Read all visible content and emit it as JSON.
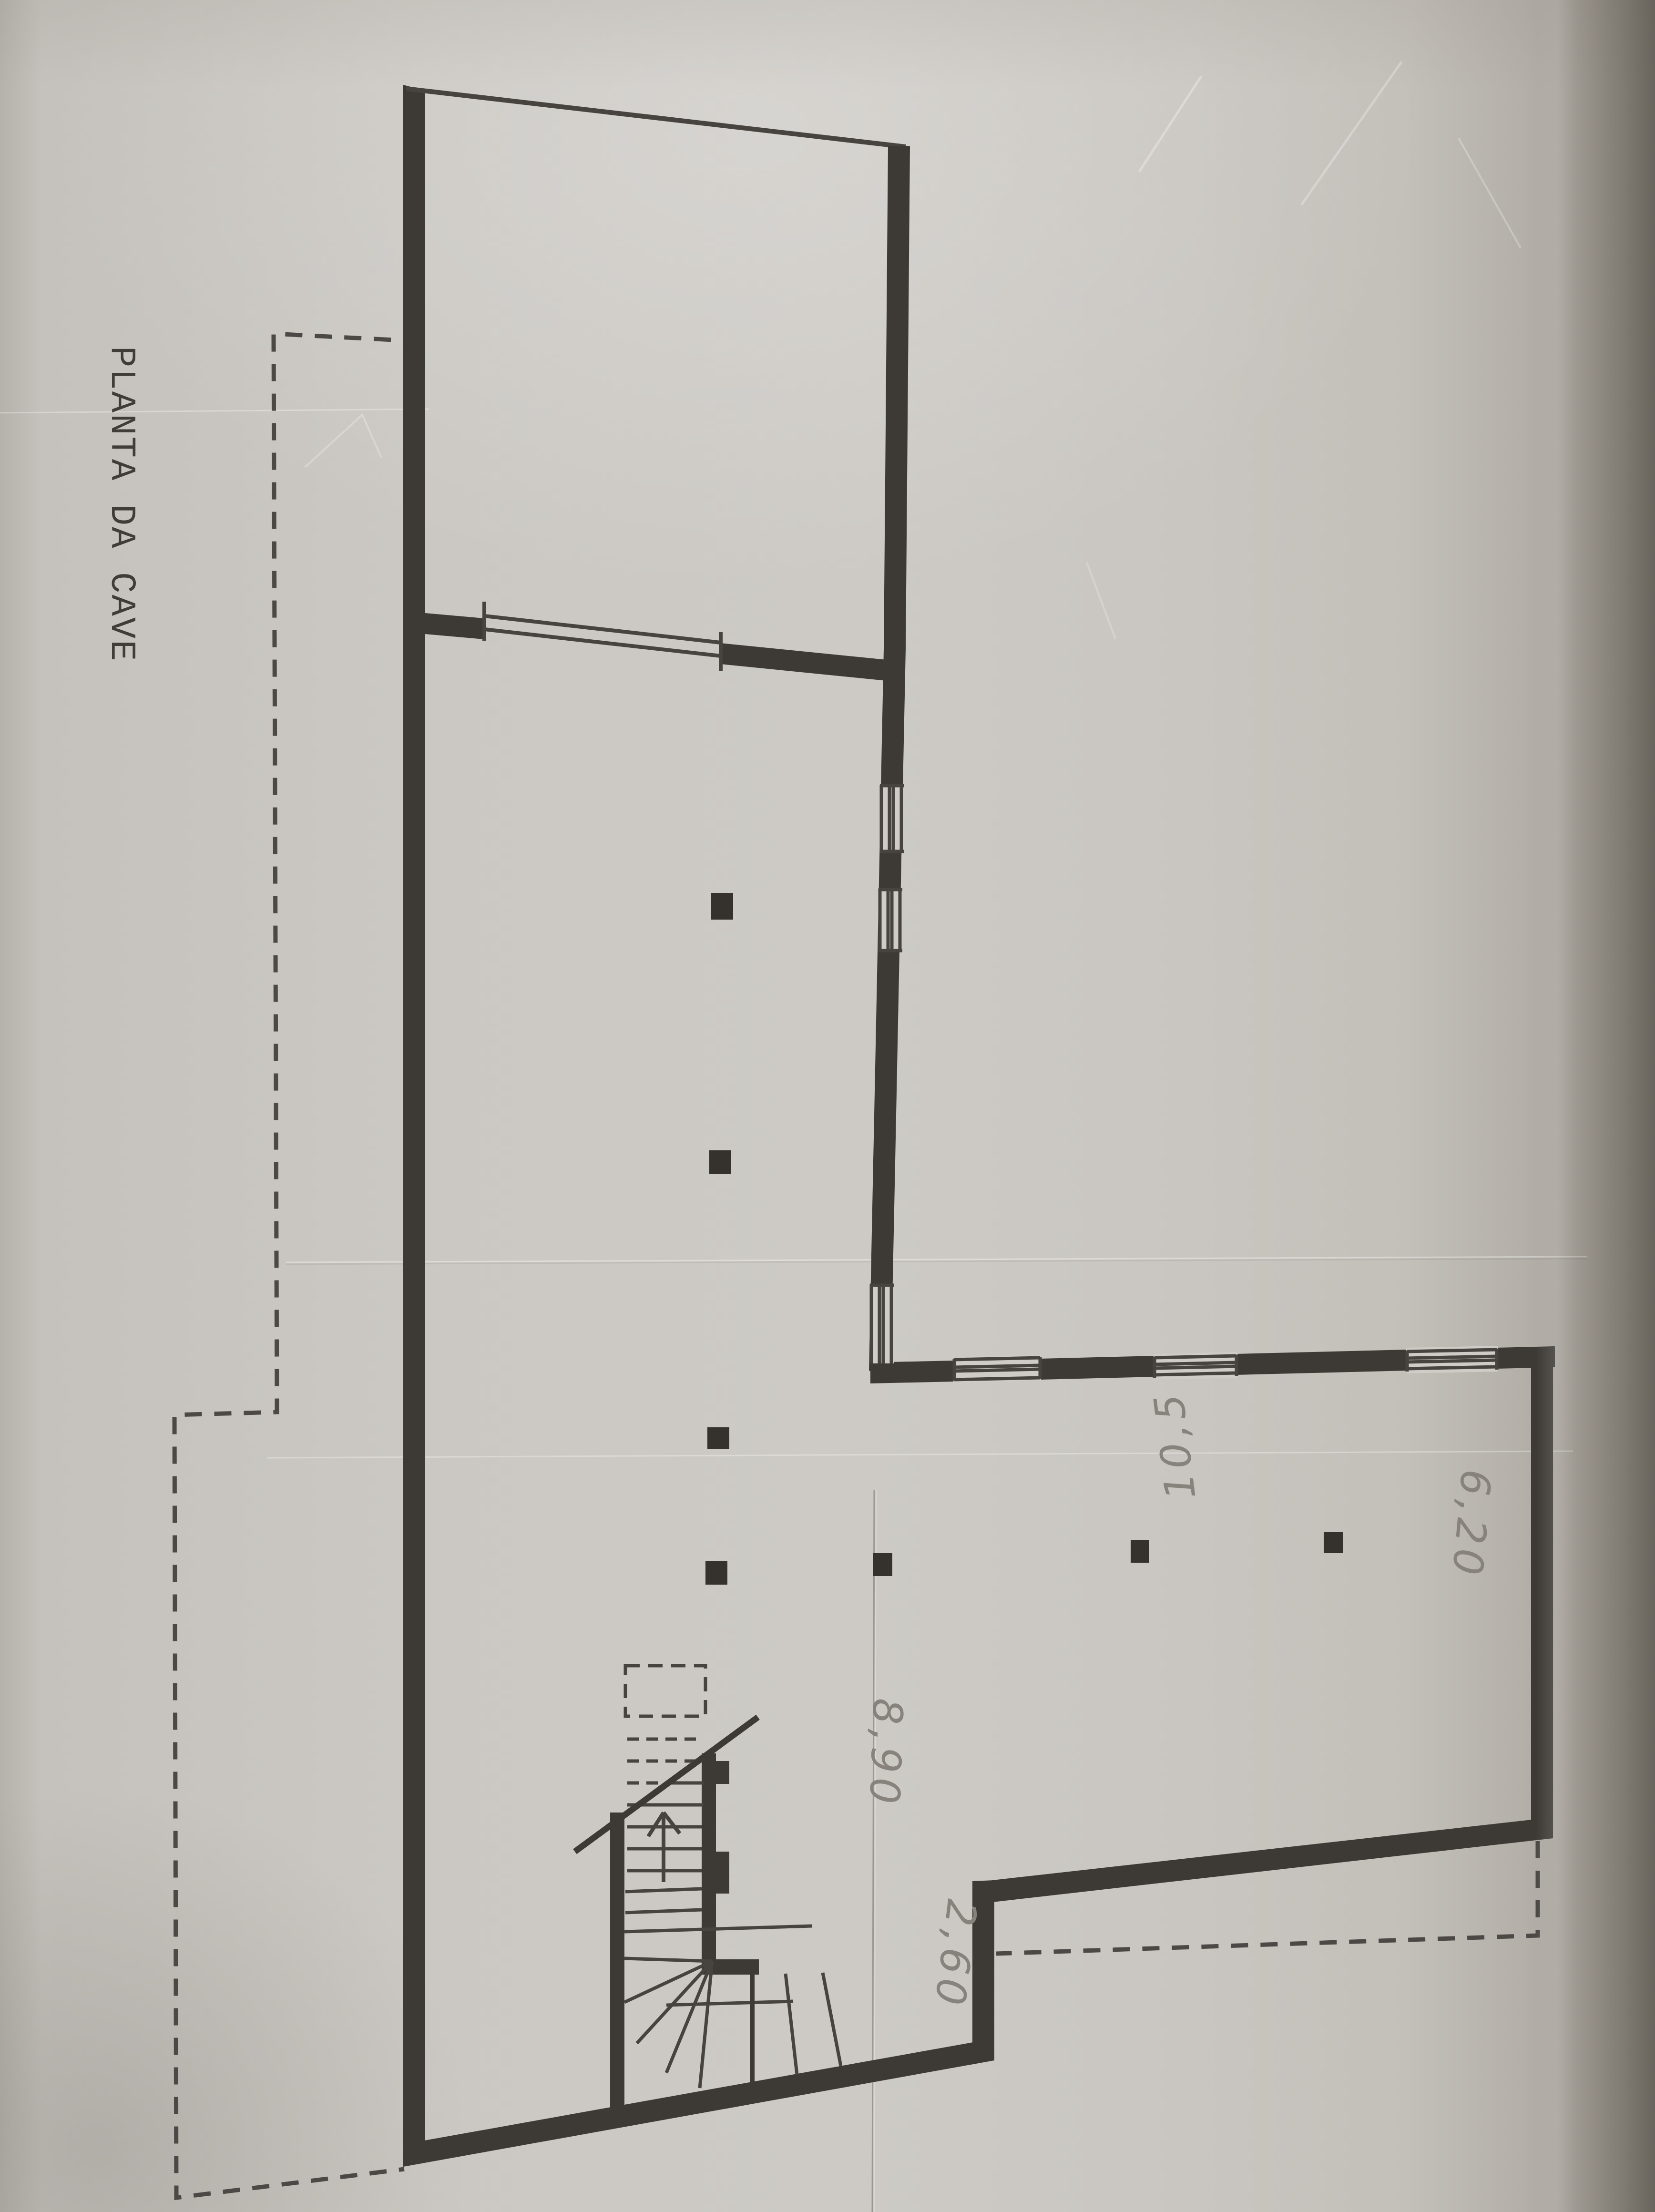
{
  "labels": {
    "title": "PLANTA DA CAVE",
    "dim_8_90": "8,90",
    "dim_2_60": "2,60",
    "dim_6_20": "6,20",
    "dim_10_5": "10,5"
  },
  "colors": {
    "paper": "#cbc8c3",
    "opening": "#cfccc7",
    "ink": "#3d3a35",
    "thin_ink": "#47443f",
    "dash_ink": "#4b4845",
    "column_ink": "#35322d",
    "pencil": "#87837c",
    "edge_shadow": "#8e897f"
  }
}
